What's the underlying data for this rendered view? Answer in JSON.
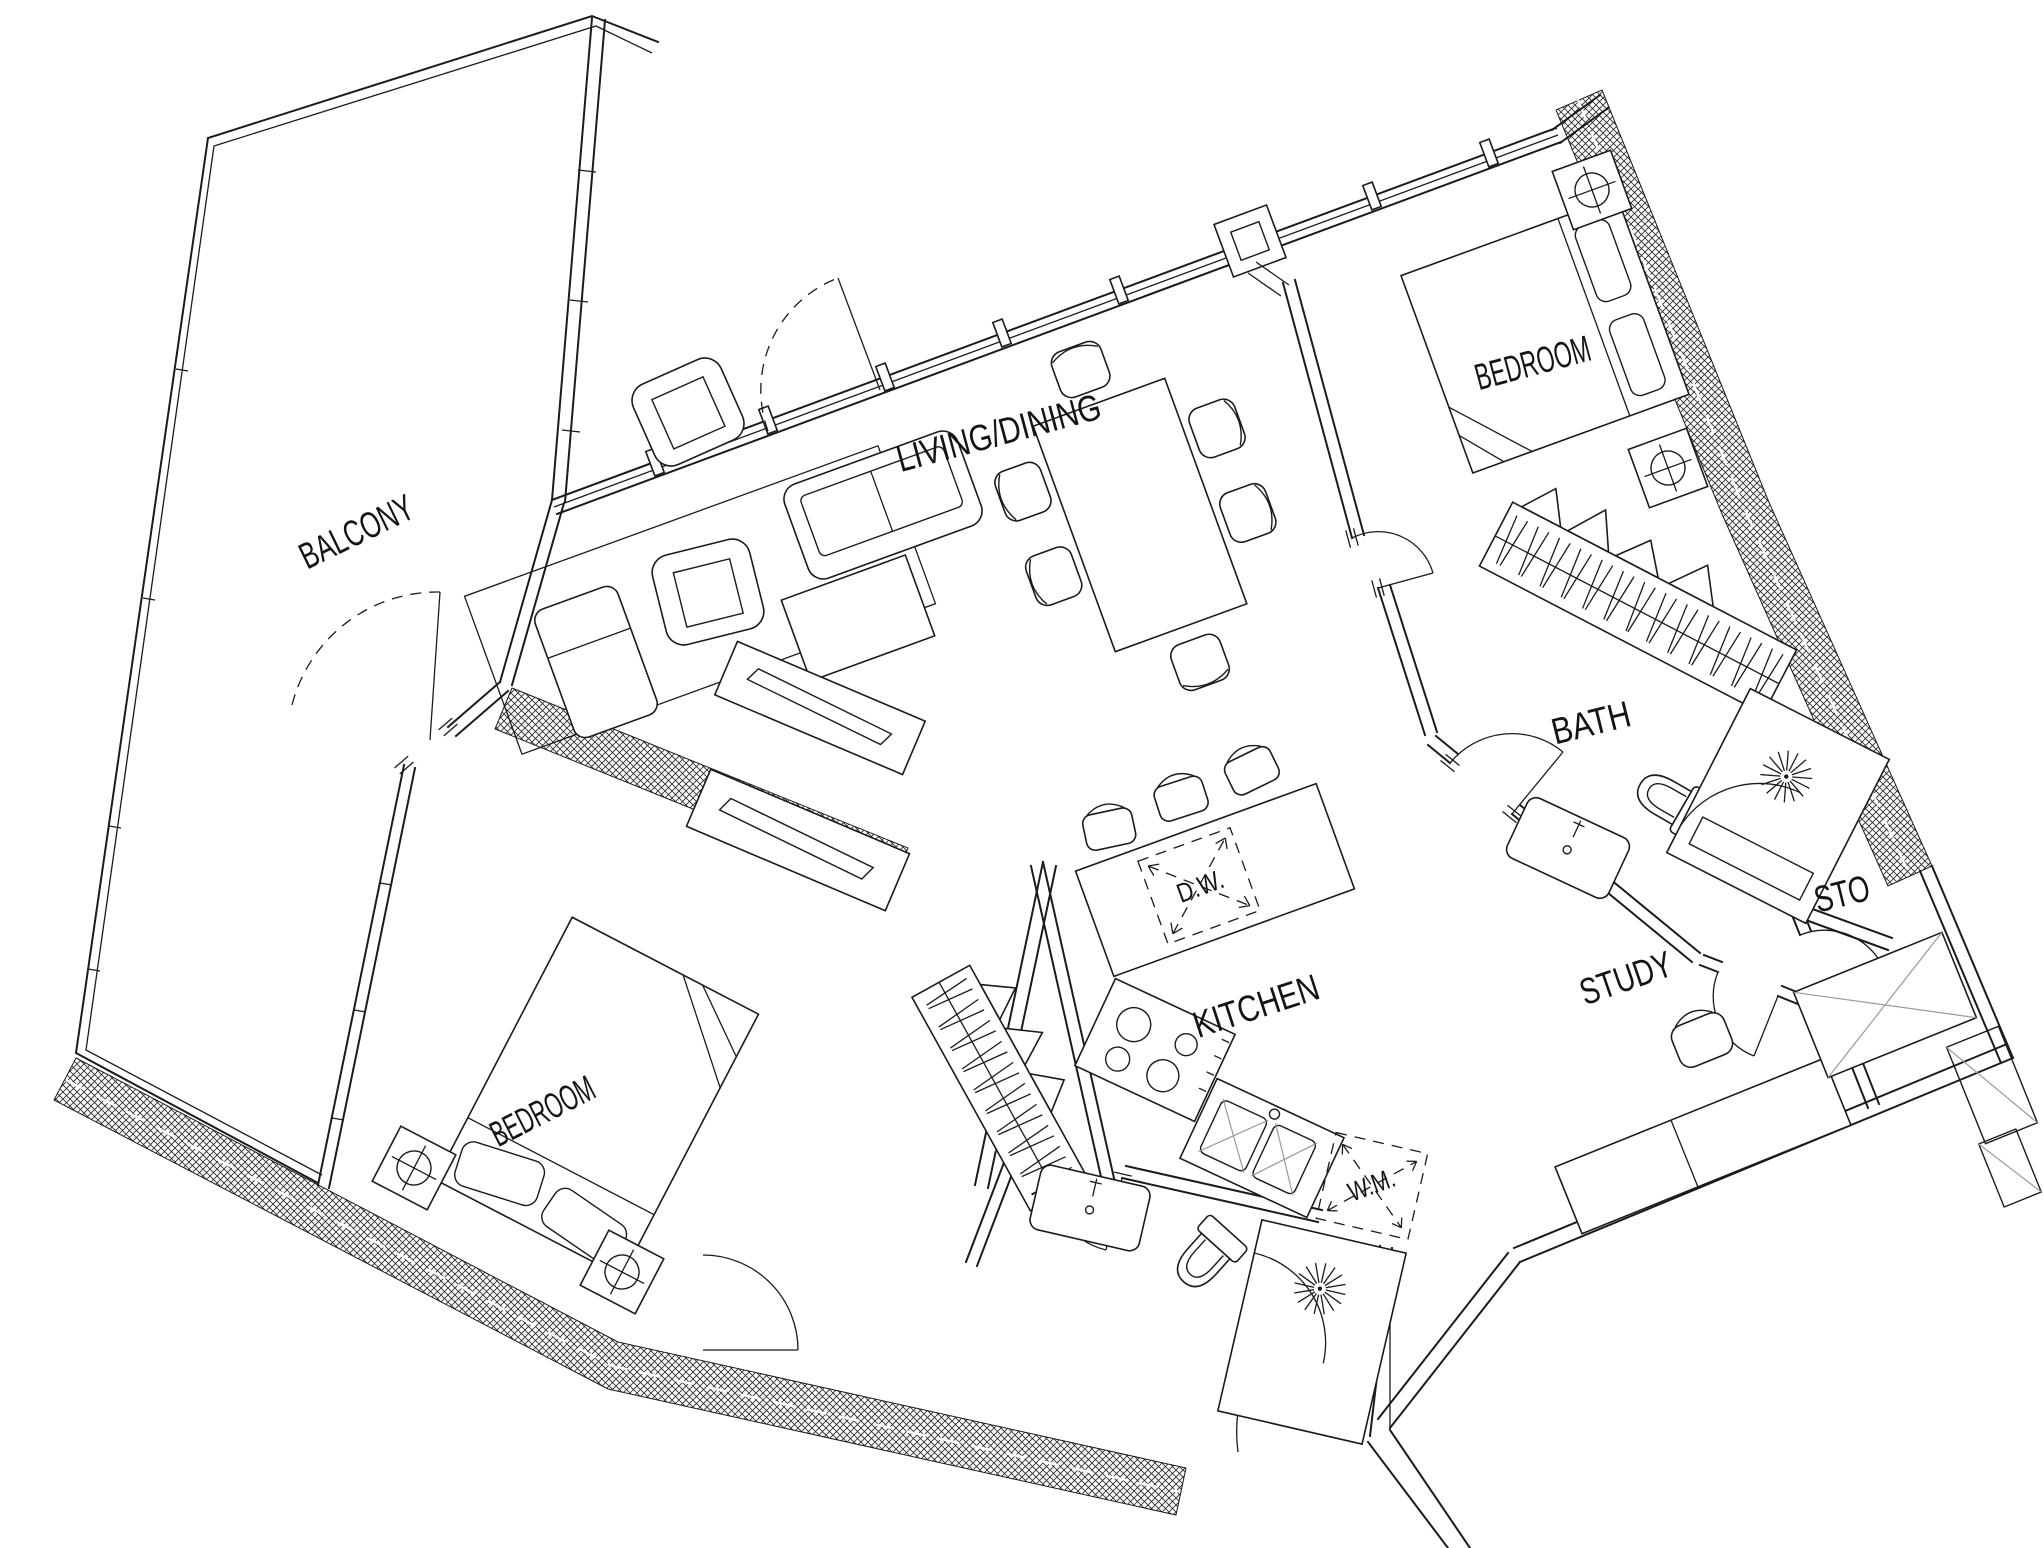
{
  "document": {
    "type": "architectural-floor-plan",
    "description": "Rotated 2-bedroom apartment floor plan line drawing",
    "background_color": "#ffffff",
    "ink_color": "#1b1b1b"
  },
  "rooms": [
    {
      "id": "balcony",
      "label": "BALCONY"
    },
    {
      "id": "living-dining",
      "label": "LIVING/DINING"
    },
    {
      "id": "bedroom-master",
      "label": "BEDROOM"
    },
    {
      "id": "bath",
      "label": "BATH"
    },
    {
      "id": "kitchen",
      "label": "KITCHEN"
    },
    {
      "id": "study",
      "label": "STUDY"
    },
    {
      "id": "storage",
      "label": "STO"
    },
    {
      "id": "bedroom-second",
      "label": "BEDROOM"
    }
  ],
  "appliances": [
    {
      "id": "dishwasher",
      "label": "D.W."
    },
    {
      "id": "washing-machine",
      "label": "W.M."
    }
  ]
}
